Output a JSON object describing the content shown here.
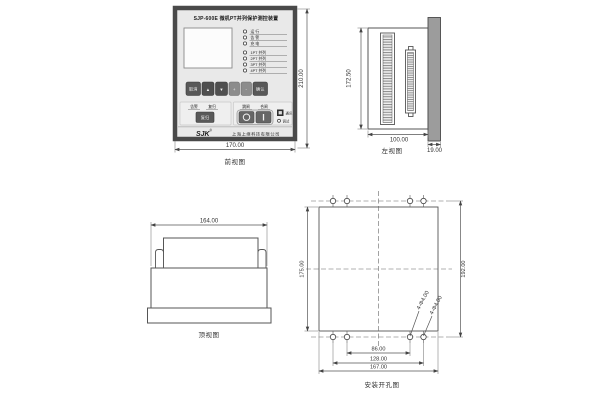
{
  "front_view": {
    "caption": "前视图",
    "dim_width": "170.00",
    "dim_height": "210.00",
    "device": {
      "title": "SJP-600E 微机PT并列保护测控装置",
      "status_leds": [
        "运 行",
        "告 警",
        "充 电"
      ],
      "function_leds": [
        "1PT 并列",
        "2PT 并列",
        "3PT 并列",
        "4PT 并列"
      ],
      "keys": [
        "取消",
        "▲",
        "▼",
        "+",
        "-",
        "确认"
      ],
      "signal_labels": [
        "告警",
        "复归"
      ],
      "reset_key": "复归",
      "switch_labels": [
        "跳闸",
        "合闸"
      ],
      "comm_label": "通讯",
      "debug_label": "调试",
      "brand": "SJK",
      "brand_mark": "®",
      "company": "上海上继科技有限公司"
    }
  },
  "side_view": {
    "caption": "左视图",
    "dim_height": "172.50",
    "dim_depth": "100.00",
    "dim_panel_thickness": "19.00"
  },
  "top_view": {
    "caption": "顶视图",
    "dim_width": "164.00"
  },
  "cutout_view": {
    "caption": "安装开孔图",
    "dim_cutout_height": "175.00",
    "dim_hole_span_vertical": "192.00",
    "dim_inner_hole_span": "86.00",
    "dim_outer_hole_span": "128.00",
    "dim_cutout_width": "167.00",
    "hole_note_inner": "4-Φ4.00",
    "hole_note_outer": "4-Φ4.00"
  }
}
